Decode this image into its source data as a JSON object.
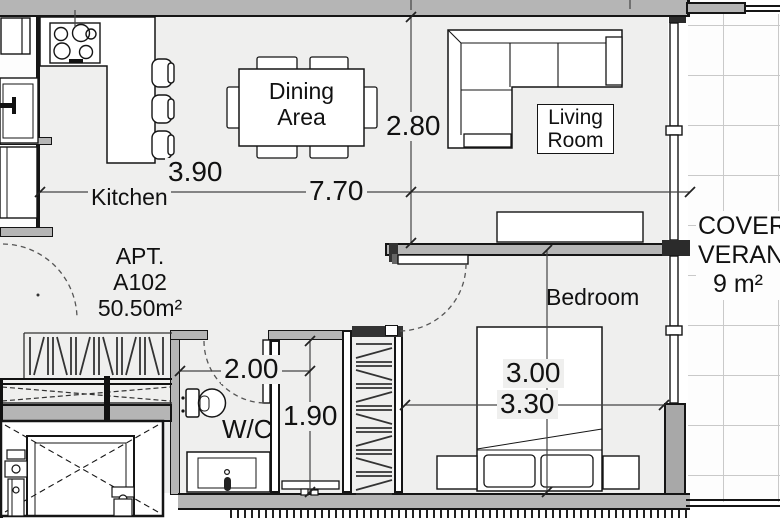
{
  "rooms": {
    "kitchen": {
      "label": "Kitchen"
    },
    "dining": {
      "line1": "Dining",
      "line2": "Area"
    },
    "living": {
      "line1": "Living",
      "line2": "Room"
    },
    "bedroom": {
      "label": "Bedroom"
    },
    "wc": {
      "label": "W/C"
    }
  },
  "apartment": {
    "line1": "APT.",
    "line2": "A102",
    "area": "50.50m²"
  },
  "veranda": {
    "line1": "COVERED",
    "line2": "VERANDA",
    "area": "9 m²"
  },
  "dimensions": {
    "kitchen_width": "3.90",
    "overall_width": "7.70",
    "living_depth": "2.80",
    "wc_width": "2.00",
    "bath_depth": "1.90",
    "bed_width": "3.00",
    "bedroom_width": "3.30"
  },
  "colors": {
    "wall": "#b5b5b5",
    "floor": "#efefee",
    "line": "#151515",
    "tile_line": "#c9c9c9"
  }
}
